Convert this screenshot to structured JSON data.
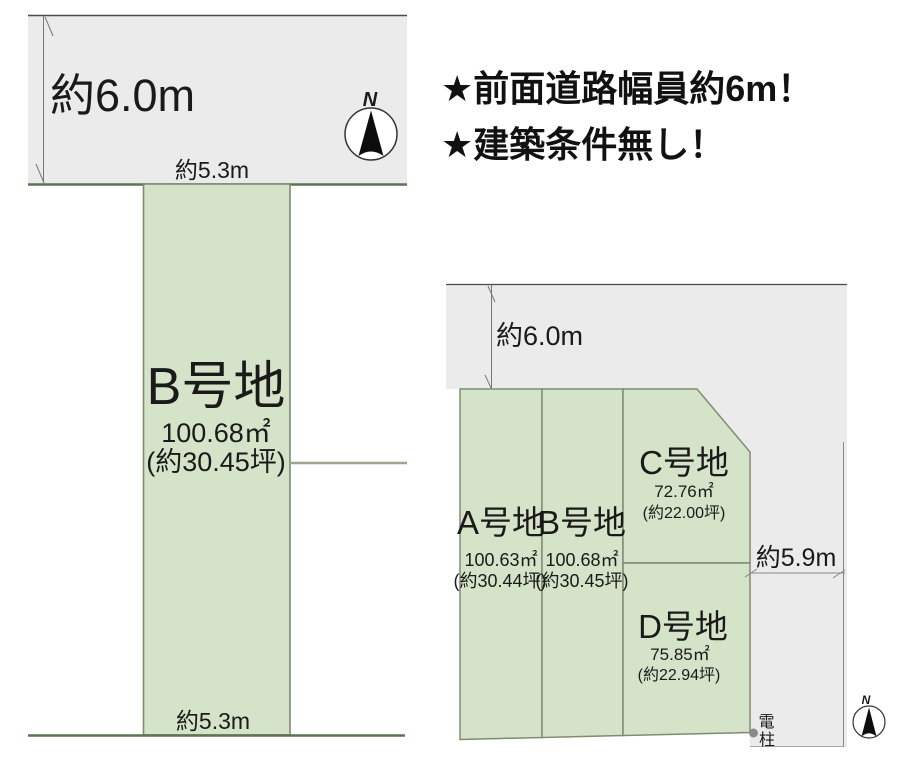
{
  "headline": {
    "line1": "★前面道路幅員約6m！",
    "line2": "★建築条件無し！"
  },
  "detail_plan": {
    "road_width_label": "約6.0m",
    "frontage_top_label": "約5.3m",
    "frontage_bottom_label": "約5.3m",
    "compass_label": "N",
    "plot": {
      "name": "B号地",
      "area_sqm": "100.68㎡",
      "area_tsubo": "(約30.45坪)"
    }
  },
  "overview_plan": {
    "road_width_label": "約6.0m",
    "side_road_width_label": "約5.9m",
    "compass_label": "N",
    "plots": [
      {
        "name": "A号地",
        "area_sqm": "100.63㎡",
        "area_tsubo": "(約30.44坪)"
      },
      {
        "name": "B号地",
        "area_sqm": "100.68㎡",
        "area_tsubo": "(約30.45坪)"
      },
      {
        "name": "C号地",
        "area_sqm": "72.76㎡",
        "area_tsubo": "(約22.00坪)"
      },
      {
        "name": "D号地",
        "area_sqm": "75.85㎡",
        "area_tsubo": "(約22.94坪)"
      }
    ],
    "utility_pole_chars": [
      "電",
      "柱"
    ]
  },
  "colors": {
    "plot_fill": "#d5e3c9",
    "plot_border": "#7e8c72",
    "road_fill": "#ebebeb",
    "road_border": "#4a4a4a",
    "boundary_line": "#5c7452",
    "text": "#1a1a1a"
  }
}
